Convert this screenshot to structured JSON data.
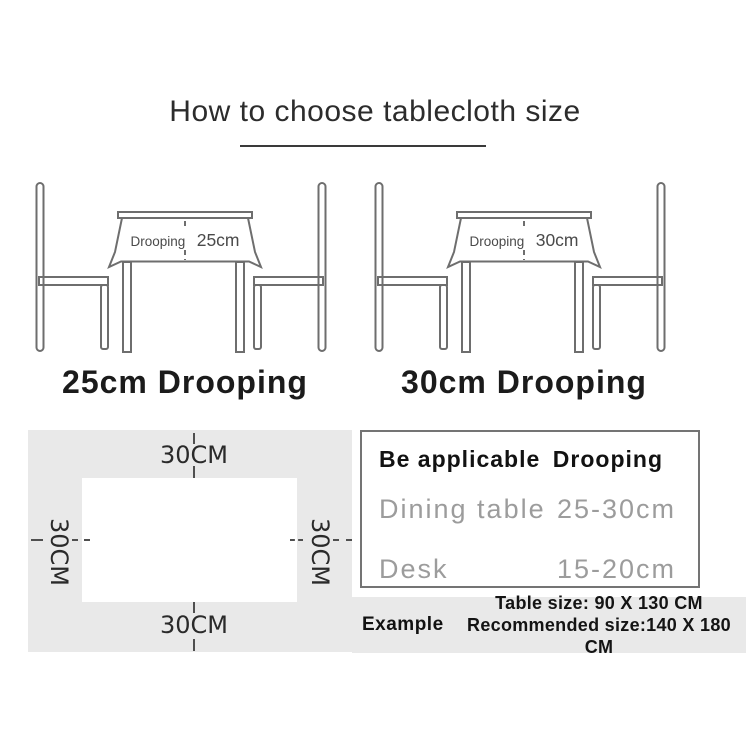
{
  "title": "How to choose tablecloth size",
  "diagrams": [
    {
      "cloth_label": "Drooping",
      "cloth_value": "25cm",
      "caption": "25cm Drooping"
    },
    {
      "cloth_label": "Drooping",
      "cloth_value": "30cm",
      "caption": "30cm Drooping"
    }
  ],
  "size_diagram": {
    "top_label": "30CM",
    "bottom_label": "30CM",
    "left_label": "30CM",
    "right_label": "30CM"
  },
  "spec_table": {
    "header": {
      "col1": "Be applicable",
      "col2": "Drooping"
    },
    "rows": [
      {
        "col1": "Dining table",
        "col2": "25-30cm"
      },
      {
        "col1": "Desk",
        "col2": "15-20cm"
      }
    ]
  },
  "example": {
    "label": "Example",
    "table_size_line": "Table size:  90 X 130 CM",
    "recommended_line": "Recommended size:140 X 180 CM"
  },
  "colors": {
    "furniture_line": "#6e6e6e",
    "panel_gray": "#e9e9e9",
    "muted_text": "#9c9c9c",
    "dark_text": "#1b1b1b",
    "underline": "#3a3a3a"
  }
}
